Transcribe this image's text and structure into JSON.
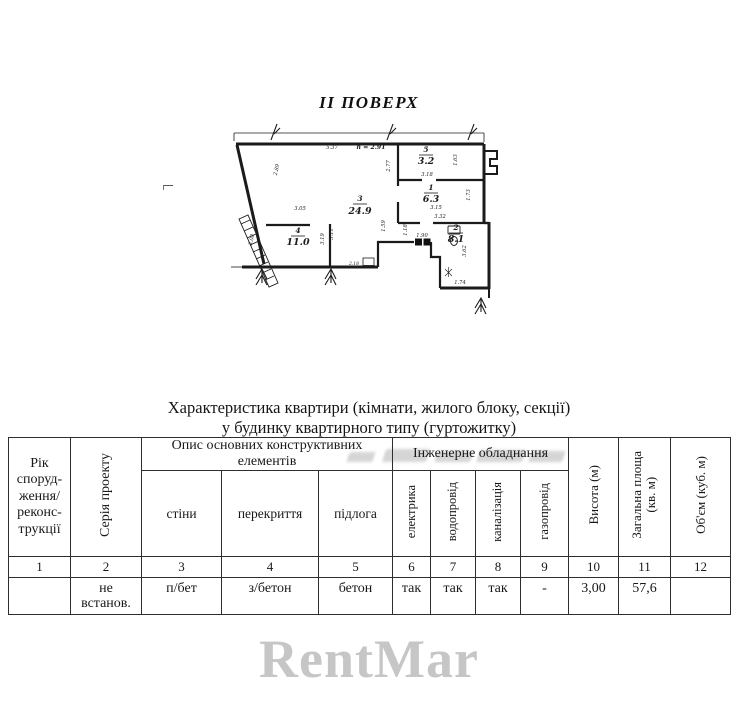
{
  "page": {
    "plan_title": "II ПОВЕРХ",
    "bottom_watermark": "RentMar"
  },
  "plan": {
    "height_note": "h = 2.91",
    "rooms": [
      {
        "num": "3",
        "area": "24.9"
      },
      {
        "num": "4",
        "area": "11.0"
      },
      {
        "num": "5",
        "area": "3.2"
      },
      {
        "num": "1",
        "area": "6.3"
      },
      {
        "num": "2",
        "area": "8.1"
      }
    ],
    "dims": [
      "5.37",
      "2.89",
      "3.05",
      "2.77",
      "3.18",
      "1.63",
      "1.73",
      "3.15",
      "3.32",
      "3.19",
      "3.11",
      "1.59",
      "1.18",
      "1.90",
      "3.62",
      "1.74",
      "2.18",
      "3.08"
    ]
  },
  "table": {
    "title_line1": "Характеристика квартири (кімнати, жилого блоку, секції)",
    "title_line2": "у будинку квартирного типу (гуртожитку)",
    "headers": {
      "year": "Рік\nспоруд-\nження/\nреконс-\nтрукції",
      "series": "Серія проекту",
      "construct_group": "Опис основних конструктивних\nелементів",
      "walls": "стіни",
      "ceilings": "перекриття",
      "floor": "підлога",
      "engineering_group": "Інженерне обладнання",
      "electricity": "електрика",
      "water": "водопровід",
      "sewerage": "каналізація",
      "gas": "газопровід",
      "height": "Висота (м)",
      "total_area": "Загальна площа\n(кв. м)",
      "volume": "Об'єм (куб. м)"
    },
    "col_numbers": [
      "1",
      "2",
      "3",
      "4",
      "5",
      "6",
      "7",
      "8",
      "9",
      "10",
      "11",
      "12"
    ],
    "row": {
      "year": "",
      "series": "не\nвстанов.",
      "walls": "п/бет",
      "ceilings": "з/бетон",
      "floor": "бетон",
      "electricity": "так",
      "water": "так",
      "sewerage": "так",
      "gas": "-",
      "height": "3,00",
      "total_area": "57,6",
      "volume": ""
    }
  }
}
